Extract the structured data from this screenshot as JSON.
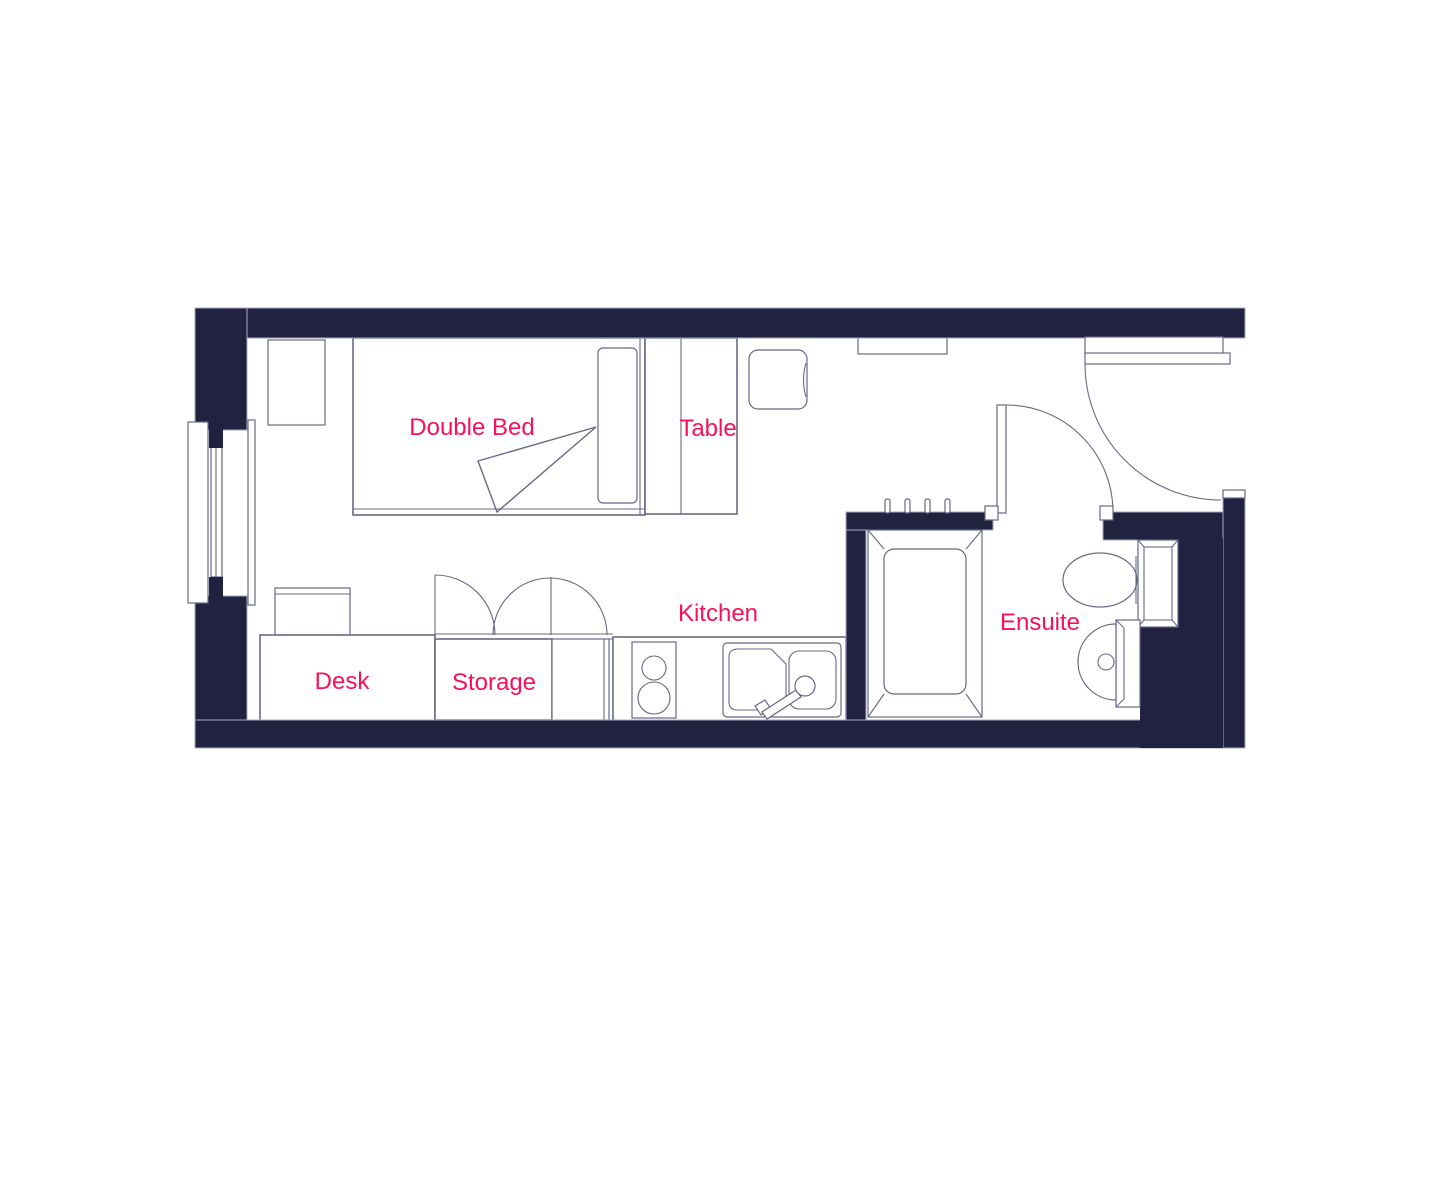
{
  "plan": {
    "labels": {
      "double_bed": "Double Bed",
      "table": "Table",
      "kitchen": "Kitchen",
      "desk": "Desk",
      "storage": "Storage",
      "ensuite": "Ensuite"
    },
    "colors": {
      "wall": "#212140",
      "wall_outline": "#a9a9c0",
      "line": "#686887",
      "label": "#f8115a",
      "background": "#ffffff"
    }
  }
}
